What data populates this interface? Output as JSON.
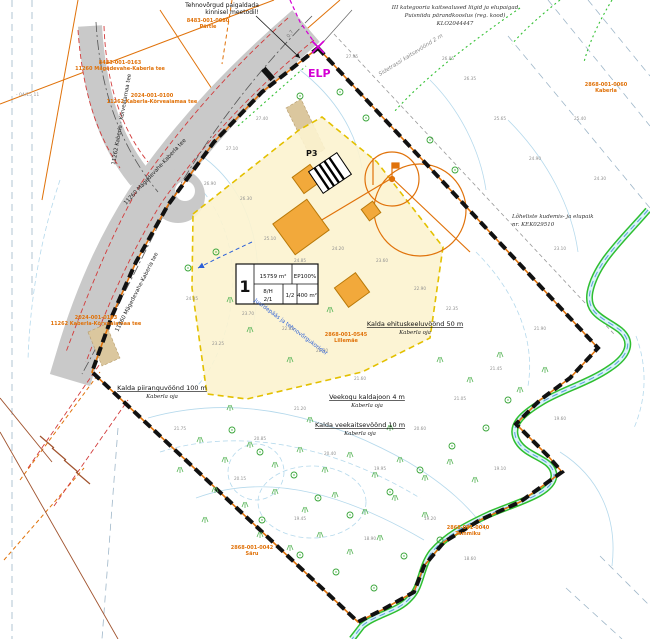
{
  "map": {
    "colors": {
      "boundary": "#111111",
      "cadastral_orange": "#e0720a",
      "road_gray": "#c9c9c9",
      "plot_fill": "#fcf3cf",
      "building_orange": "#f2a93b",
      "stream_green": "#2fbf2f",
      "water_blue": "#5aa0d8",
      "magenta": "#d400d4",
      "road_edge_red": "#d23b3b",
      "contour_blue": "#b5d9ec"
    },
    "notes": {
      "top_left": {
        "line1": "Tehnovõrgud paigaldada",
        "line2": "kinnisel meetodil!"
      },
      "top_right": {
        "line1": "III kategooria kaitsealused liigid ja elupaigad",
        "line2": "Puisniidu pärandkooslus (reg. kood)",
        "line3": "KLO2044447"
      },
      "right": {
        "line1": "Lõheliste kudemis- ja elupaik",
        "line2": "nr. KEK029510"
      }
    },
    "labels": {
      "elp": "ELP",
      "p3": "P3",
      "road_main": "11260 Mägedevahe-Kaberla tee",
      "road_branch": "11262 Kaberla - Kõrveaiamaa tee",
      "side_zone": "Sidetrassi kaitsevöönd 2 m",
      "access": "Juurdepääs ja tehnovõrgukoridor",
      "dim": "0.7",
      "sheet": "- 04/15 11"
    },
    "zone_labels": [
      {
        "x": 415,
        "y": 326,
        "title": "Kalda ehituskeeluvöönd 50 m",
        "sub": "Kaberla oja"
      },
      {
        "x": 162,
        "y": 390,
        "title": "Kalda piiranguvöönd 100 m",
        "sub": "Kaberla oja"
      },
      {
        "x": 367,
        "y": 399,
        "title": "Veekogu kaldajoon 4 m",
        "sub": "Kaberla oja"
      },
      {
        "x": 360,
        "y": 427,
        "title": "Kalda veekaitsevöönd 10 m",
        "sub": "Kaberla oja"
      }
    ],
    "cadastral_labels": [
      {
        "x": 208,
        "y": 22,
        "l1": "8483-001-0080",
        "l2": "Pärtle"
      },
      {
        "x": 120,
        "y": 64,
        "l1": "8483-001-0163",
        "l2": "11260 Mägedevahe-Kaberla tee"
      },
      {
        "x": 152,
        "y": 97,
        "l1": "2024-001-0100",
        "l2": "11262 Kaberla-Kõrveaiamaa tee"
      },
      {
        "x": 96,
        "y": 319,
        "l1": "2024-001-0103",
        "l2": "11262 Kaberla-Kõrveaiamaa tee"
      },
      {
        "x": 346,
        "y": 336,
        "l1": "2868-001-0545",
        "l2": "Lillemäe"
      },
      {
        "x": 252,
        "y": 549,
        "l1": "2868-001-0042",
        "l2": "Säru"
      },
      {
        "x": 468,
        "y": 529,
        "l1": "2868-001-0040",
        "l2": "Tammiku"
      },
      {
        "x": 606,
        "y": 86,
        "l1": "2868-001-0060",
        "l2": "Kaberla"
      }
    ],
    "plot_table": {
      "num": "1",
      "area": "15759 m²",
      "ep": "EP100%",
      "c1a": "8/H",
      "c1b": "2/1",
      "c2": "1/2",
      "c3": "400 m²"
    },
    "spot_heights": [
      {
        "x": 352,
        "y": 58,
        "t": "27.95"
      },
      {
        "x": 448,
        "y": 60,
        "t": "26.85"
      },
      {
        "x": 470,
        "y": 80,
        "t": "26.35"
      },
      {
        "x": 500,
        "y": 120,
        "t": "25.65"
      },
      {
        "x": 535,
        "y": 160,
        "t": "24.90"
      },
      {
        "x": 262,
        "y": 120,
        "t": "27.40"
      },
      {
        "x": 232,
        "y": 150,
        "t": "27.10"
      },
      {
        "x": 210,
        "y": 185,
        "t": "26.90"
      },
      {
        "x": 246,
        "y": 200,
        "t": "26.30"
      },
      {
        "x": 270,
        "y": 240,
        "t": "25.10"
      },
      {
        "x": 300,
        "y": 262,
        "t": "24.85"
      },
      {
        "x": 338,
        "y": 250,
        "t": "24.20"
      },
      {
        "x": 382,
        "y": 262,
        "t": "23.60"
      },
      {
        "x": 420,
        "y": 290,
        "t": "22.90"
      },
      {
        "x": 452,
        "y": 310,
        "t": "22.35"
      },
      {
        "x": 248,
        "y": 315,
        "t": "23.70"
      },
      {
        "x": 218,
        "y": 345,
        "t": "23.25"
      },
      {
        "x": 192,
        "y": 300,
        "t": "24.05"
      },
      {
        "x": 288,
        "y": 330,
        "t": "22.85"
      },
      {
        "x": 322,
        "y": 352,
        "t": "22.40"
      },
      {
        "x": 360,
        "y": 380,
        "t": "21.60"
      },
      {
        "x": 300,
        "y": 410,
        "t": "21.20"
      },
      {
        "x": 260,
        "y": 440,
        "t": "20.85"
      },
      {
        "x": 330,
        "y": 455,
        "t": "20.40"
      },
      {
        "x": 380,
        "y": 470,
        "t": "19.95"
      },
      {
        "x": 420,
        "y": 430,
        "t": "20.60"
      },
      {
        "x": 460,
        "y": 400,
        "t": "21.05"
      },
      {
        "x": 496,
        "y": 370,
        "t": "21.45"
      },
      {
        "x": 540,
        "y": 330,
        "t": "21.90"
      },
      {
        "x": 560,
        "y": 420,
        "t": "19.60"
      },
      {
        "x": 430,
        "y": 520,
        "t": "19.20"
      },
      {
        "x": 370,
        "y": 540,
        "t": "18.90"
      },
      {
        "x": 300,
        "y": 520,
        "t": "19.45"
      },
      {
        "x": 240,
        "y": 480,
        "t": "20.15"
      },
      {
        "x": 180,
        "y": 430,
        "t": "21.75"
      },
      {
        "x": 500,
        "y": 470,
        "t": "19.10"
      },
      {
        "x": 470,
        "y": 560,
        "t": "18.60"
      },
      {
        "x": 560,
        "y": 250,
        "t": "23.10"
      },
      {
        "x": 600,
        "y": 180,
        "t": "24.30"
      },
      {
        "x": 580,
        "y": 120,
        "t": "25.40"
      }
    ],
    "trees": [
      [
        340,
        92
      ],
      [
        366,
        118
      ],
      [
        300,
        96
      ],
      [
        430,
        140
      ],
      [
        455,
        170
      ],
      [
        216,
        252
      ],
      [
        188,
        268
      ],
      [
        294,
        475
      ],
      [
        318,
        498
      ],
      [
        350,
        515
      ],
      [
        390,
        492
      ],
      [
        420,
        470
      ],
      [
        452,
        446
      ],
      [
        260,
        452
      ],
      [
        232,
        430
      ],
      [
        486,
        428
      ],
      [
        508,
        400
      ],
      [
        300,
        555
      ],
      [
        336,
        572
      ],
      [
        374,
        588
      ],
      [
        262,
        520
      ],
      [
        404,
        556
      ],
      [
        440,
        540
      ]
    ],
    "tussocks": [
      [
        200,
        440
      ],
      [
        225,
        460
      ],
      [
        250,
        445
      ],
      [
        275,
        465
      ],
      [
        300,
        450
      ],
      [
        325,
        470
      ],
      [
        350,
        455
      ],
      [
        375,
        475
      ],
      [
        400,
        460
      ],
      [
        425,
        478
      ],
      [
        450,
        462
      ],
      [
        475,
        480
      ],
      [
        215,
        490
      ],
      [
        245,
        505
      ],
      [
        275,
        492
      ],
      [
        305,
        510
      ],
      [
        335,
        495
      ],
      [
        365,
        512
      ],
      [
        395,
        498
      ],
      [
        425,
        515
      ],
      [
        260,
        535
      ],
      [
        290,
        548
      ],
      [
        320,
        535
      ],
      [
        350,
        552
      ],
      [
        380,
        538
      ],
      [
        230,
        408
      ],
      [
        310,
        420
      ],
      [
        390,
        428
      ],
      [
        180,
        470
      ],
      [
        205,
        520
      ],
      [
        440,
        360
      ],
      [
        470,
        380
      ],
      [
        500,
        355
      ],
      [
        520,
        390
      ],
      [
        545,
        370
      ],
      [
        250,
        330
      ],
      [
        290,
        360
      ],
      [
        230,
        300
      ],
      [
        330,
        310
      ]
    ]
  }
}
